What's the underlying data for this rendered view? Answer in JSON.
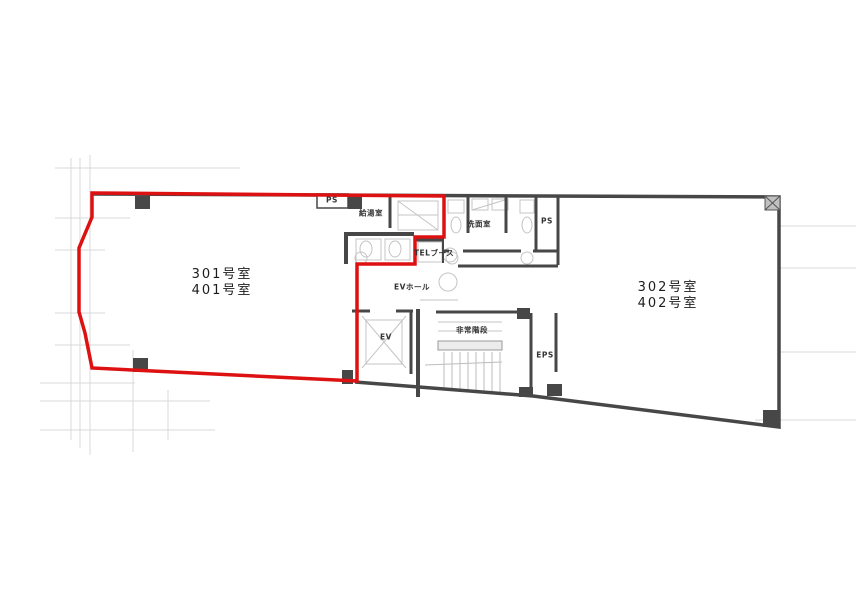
{
  "colors": {
    "tenant_outline": "#dd1111",
    "wall": "#474747",
    "fixture": "#c4c4c4",
    "grid": "#d8d8d8"
  },
  "labels": {
    "room_301": {
      "line1": "301号室",
      "line2": "401号室"
    },
    "room_302": {
      "line1": "302号室",
      "line2": "402号室"
    },
    "ps_top": "PS",
    "kitchenette": "給湯室",
    "tel_booth": "TELブース",
    "washroom": "洗面室",
    "ps_right": "PS",
    "ev_hall": "EVホール",
    "elevator": "EV",
    "stairs": "非常階段",
    "eps": "EPS"
  }
}
